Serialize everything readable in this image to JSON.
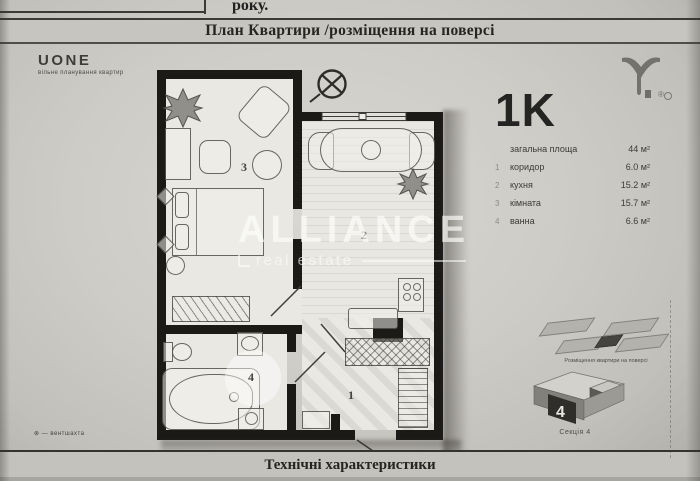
{
  "header": {
    "cell_label": "року.",
    "title": "План Квартири /розміщення на поверсі"
  },
  "brand": {
    "name": "UONE",
    "tagline": "вільне планування квартир",
    "registered": "®"
  },
  "watermark": {
    "title": "ALLIANCE",
    "subtitle": "real estate"
  },
  "apartment": {
    "type_label": "1K",
    "total_label": "загальна площа",
    "total_value": "44 м²",
    "rooms": [
      {
        "num": "1",
        "name": "коридор",
        "area": "6.0 м²"
      },
      {
        "num": "2",
        "name": "кухня",
        "area": "15.2 м²"
      },
      {
        "num": "3",
        "name": "кімната",
        "area": "15.7 м²"
      },
      {
        "num": "4",
        "name": "ванна",
        "area": "6.6 м²"
      }
    ]
  },
  "plan": {
    "labels": {
      "hall": "1",
      "kitchen": "2",
      "room": "3",
      "bath": "4"
    }
  },
  "diagrams": {
    "floor_caption": "Розміщення квартири на поверсі",
    "section_caption": "Секція 4",
    "section_number": "4"
  },
  "footnote": "⊗ — вентшахта",
  "footer": {
    "title": "Технічні характеристики"
  },
  "colors": {
    "paper": "#ceccc7",
    "wall": "#1b1a17",
    "watermark": "#fdfdfb"
  }
}
